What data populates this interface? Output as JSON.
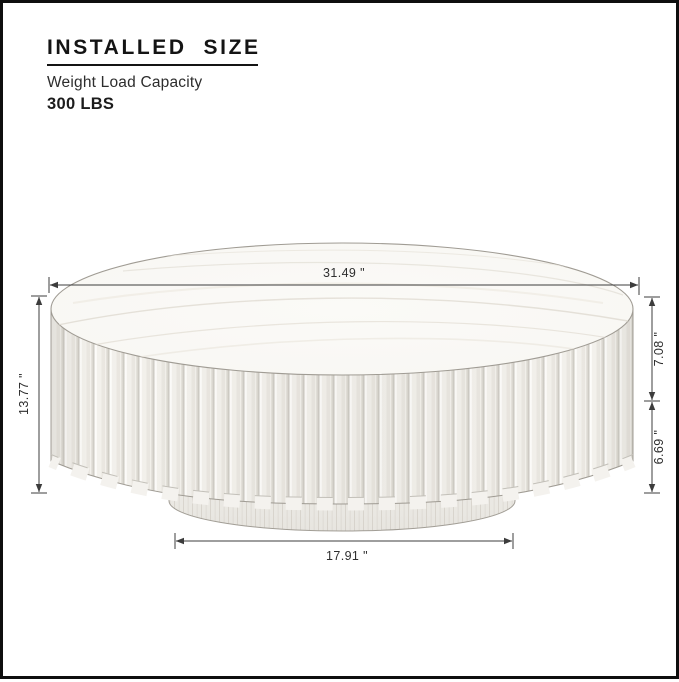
{
  "header": {
    "title": "INSTALLED  SIZE",
    "subtitle": "Weight Load Capacity",
    "capacity": "300 LBS"
  },
  "diagram": {
    "product": "round-fluted-coffee-table-with-pedestal-base",
    "units": "inches",
    "dimensions": {
      "top_diameter": "31.49 \"",
      "overall_height": "13.77 \"",
      "top_section_height": "7.08 \"",
      "base_section_height": "6.69 \"",
      "base_diameter": "17.91 \""
    },
    "colors": {
      "border": "#0e0e0e",
      "outline": "#a09c94",
      "wood_light": "#f4f2ee",
      "dimension_line": "#3c3c3c"
    }
  }
}
